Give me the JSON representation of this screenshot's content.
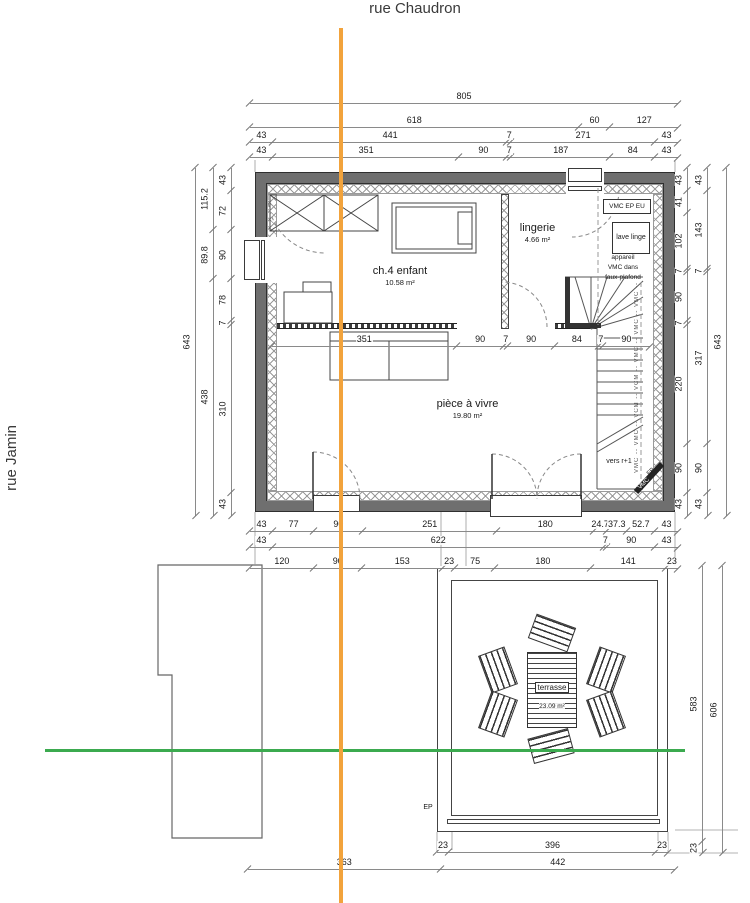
{
  "streets": {
    "top": "rue Chaudron",
    "left": "rue Jamin"
  },
  "rooms": {
    "bedroom": {
      "name": "ch.4 enfant",
      "area": "10.58 m²"
    },
    "laundry": {
      "name": "lingerie",
      "area": "4.66 m²"
    },
    "living": {
      "name": "pièce à vivre",
      "area": "19.80 m²"
    },
    "terrace": {
      "name": "terrasse",
      "area": "23.09 m²"
    }
  },
  "annotations": {
    "vmc_ep_eu": "VMC EP EU",
    "lave_linge": "lave linge",
    "appareil_line1": "appareil",
    "appareil_line2": "VMC dans",
    "appareil_line3": "faux-plafond",
    "vers_r1": "vers r+1",
    "duct_text": "VMC -- VMC -- VCM -- VCM -- VMC -- VMC -- VMC --",
    "ep_corner": "EP",
    "vmc_corner": "VMC",
    "ep_site": "EP"
  },
  "dimensions": {
    "top": [
      [
        "805"
      ],
      [
        "618",
        "60",
        "127"
      ],
      [
        "43",
        "441",
        "7",
        "271",
        "43"
      ],
      [
        "43",
        "351",
        "90",
        "7",
        "187",
        "84",
        "43"
      ]
    ],
    "interior": [
      "351",
      "90",
      "7",
      "90",
      "84",
      "7",
      "90"
    ],
    "bottom": [
      [
        "43",
        "77",
        "90",
        "251",
        "180",
        "24.7",
        "37.3",
        "52.7",
        "43"
      ],
      [
        "43",
        "622",
        "7",
        "90",
        "43"
      ],
      [
        "120",
        "90",
        "153",
        "23",
        "75",
        "180",
        "141",
        "23"
      ]
    ],
    "left": {
      "outer": [
        "643"
      ],
      "mid": [
        "115.2",
        "89.8",
        "438"
      ],
      "inner": [
        "43",
        "72",
        "90",
        "78",
        "7",
        "310",
        "43"
      ]
    },
    "right": {
      "inner": [
        "43",
        "41",
        "102",
        "7",
        "90",
        "7",
        "220",
        "90",
        "43"
      ],
      "mid": [
        "43",
        "143",
        "7",
        "317",
        "90",
        "43"
      ],
      "outer": [
        "643"
      ]
    },
    "site_right": {
      "inner": [
        "583",
        "23"
      ],
      "outer": [
        "606"
      ]
    },
    "terrace_row": [
      "23",
      "396",
      "23"
    ],
    "site_bottom": [
      "363",
      "442"
    ]
  },
  "colors": {
    "axis_orange": "#F2A33C",
    "boundary_green": "#3BAA4F",
    "wall_gray": "#6F6F6F"
  }
}
